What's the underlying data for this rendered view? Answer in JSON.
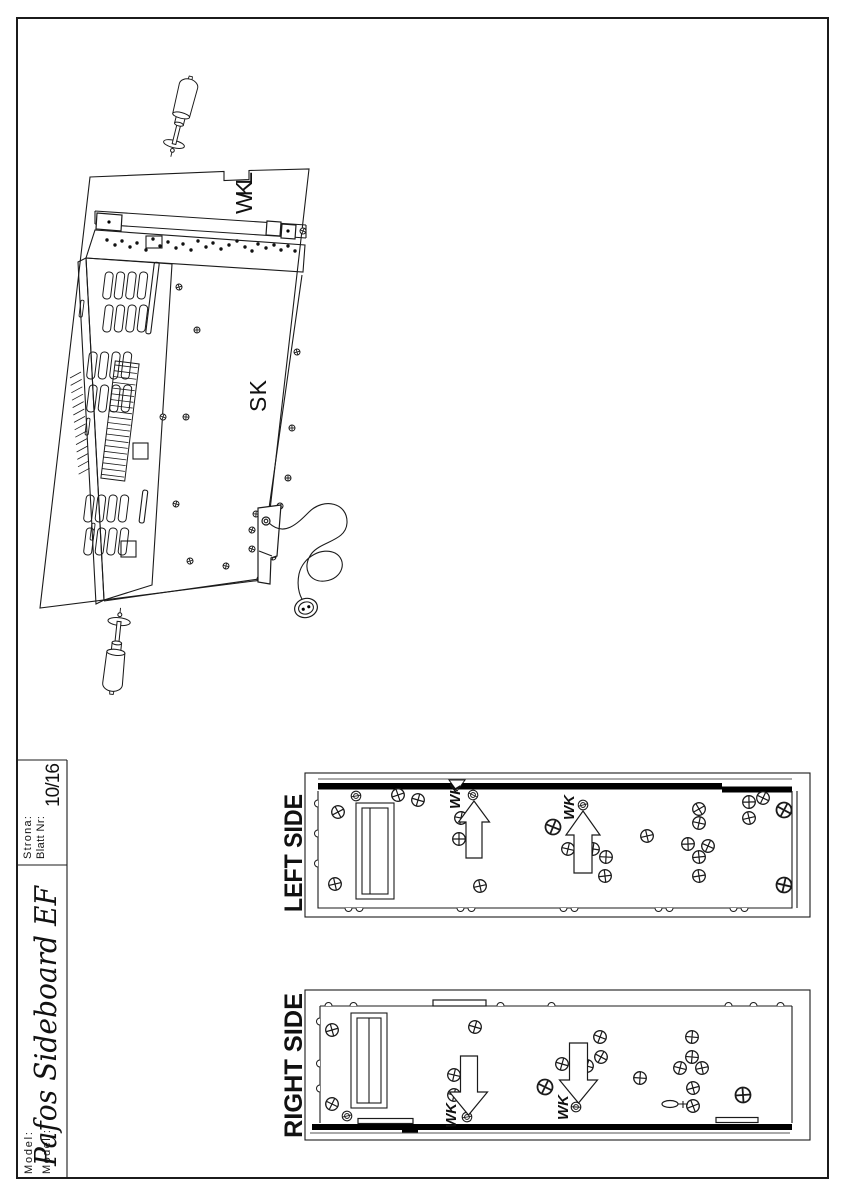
{
  "title_block": {
    "model_label": "Model:",
    "model_label_de": "Modell:",
    "model_value": "Pafos Sideboard EF",
    "page_label": "Strona:",
    "page_label_de": "Blatt Nr:",
    "page_value": "10/16"
  },
  "assembly_view": {
    "part_labels": {
      "wkl": "WKL",
      "sk": "SK"
    }
  },
  "panel_views": {
    "left": {
      "title": "LEFT SIDE",
      "fastener_labels": [
        "WK",
        "WK"
      ]
    },
    "right": {
      "title": "RIGHT SIDE",
      "fastener_labels": [
        "WK",
        "WK"
      ]
    }
  },
  "colors": {
    "line": "#1b1b1b",
    "background": "#ffffff"
  }
}
